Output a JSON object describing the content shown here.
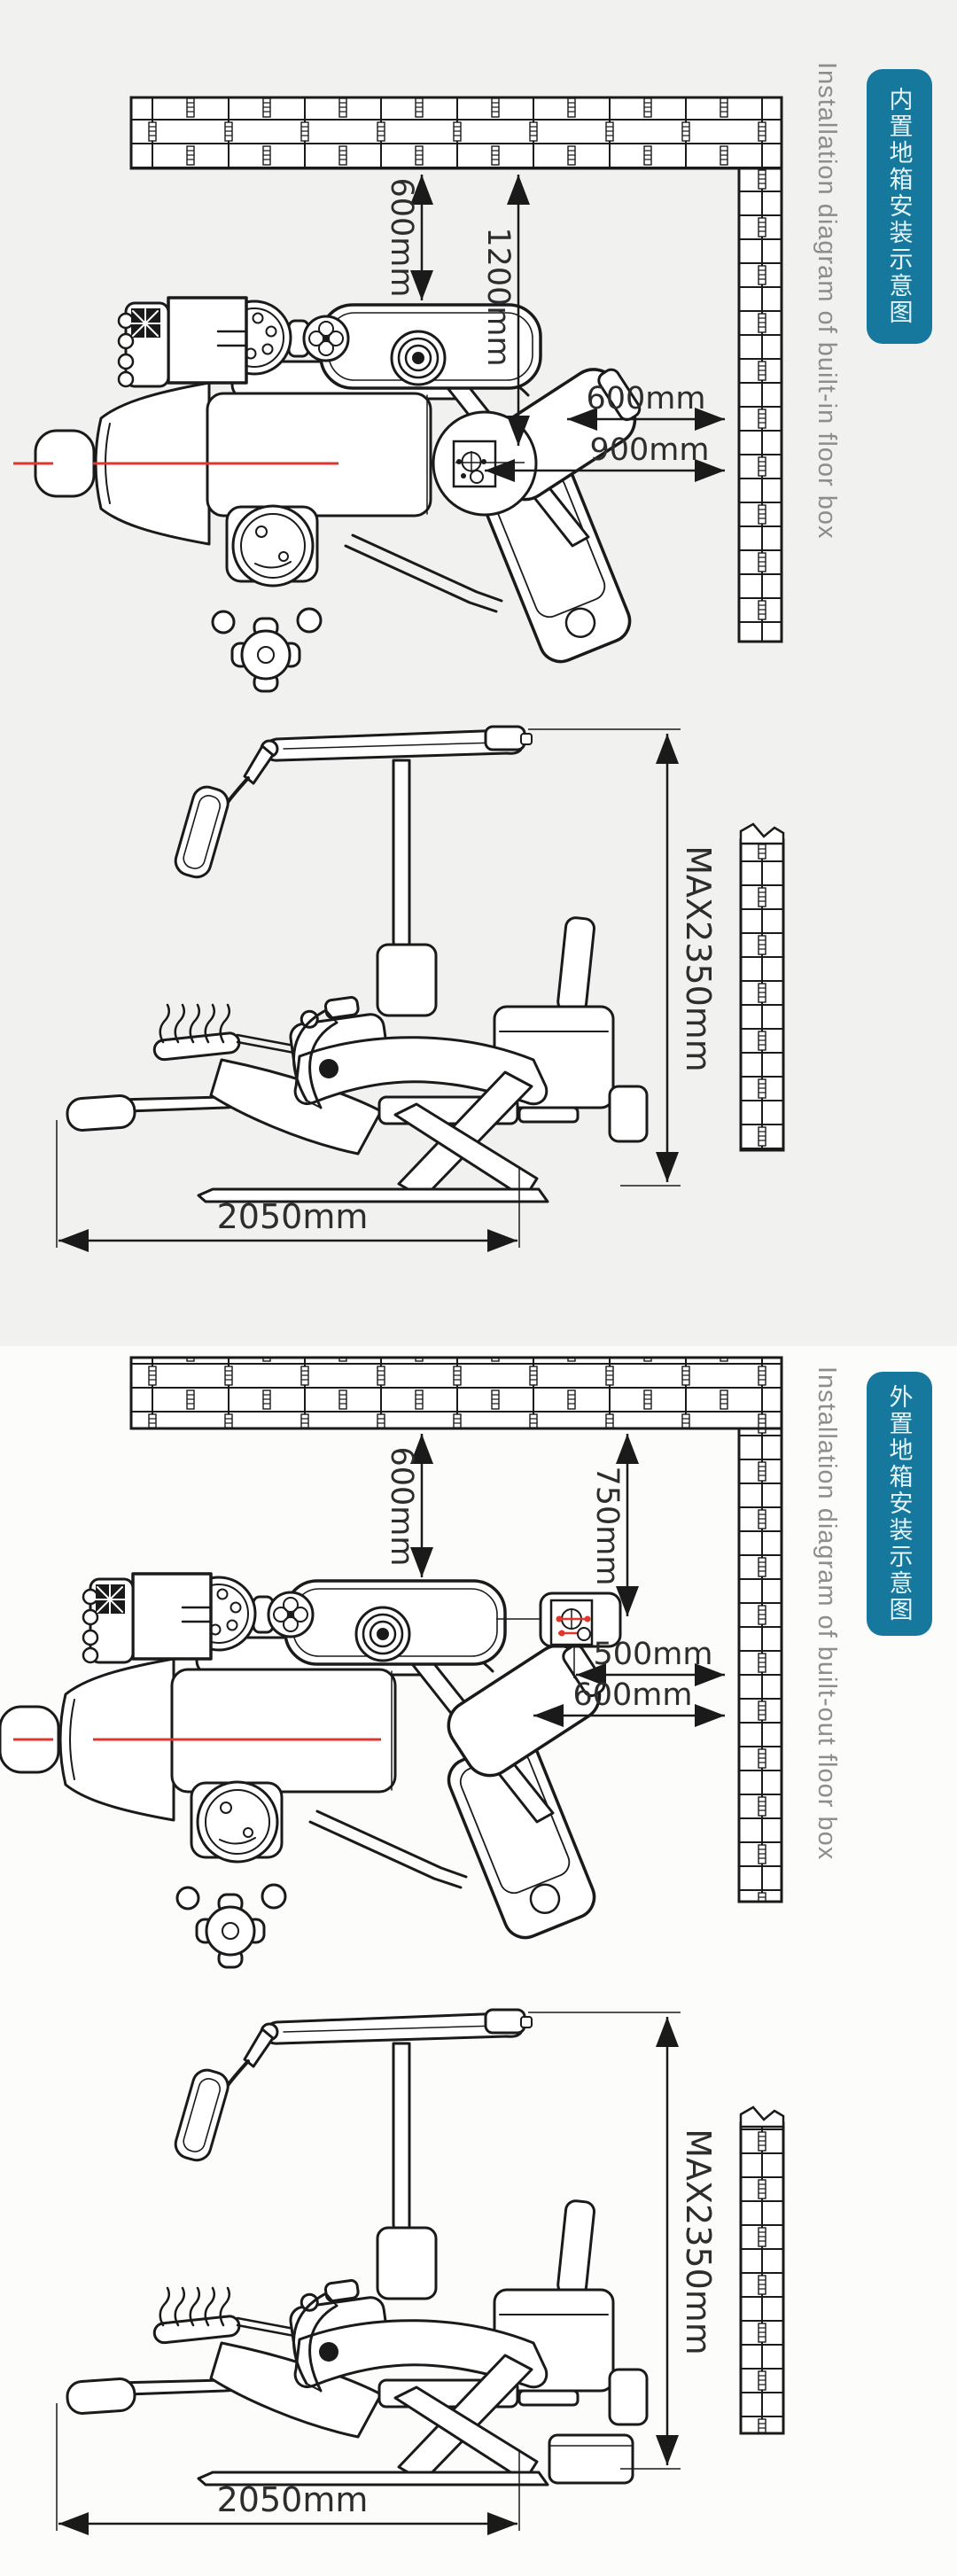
{
  "colors": {
    "badge_bg": "#17789e",
    "badge_text": "#e3f4f9",
    "caption_text": "#8d8d8d",
    "line_art": "#1a1a1a",
    "centerline_red": "#e0362c",
    "dim_text": "#2d2d2d",
    "section1_bg": "#f1f1ef",
    "section2_bg": "#fcfcfb"
  },
  "sections": [
    {
      "badge": "内置地箱安装示意图",
      "caption": "Installation diagram of built-in floor box",
      "top_view": {
        "dim_wall_to_unit": "600mm",
        "dim_wall_to_floorbox": "1200mm",
        "dim_unit_to_wall": "600mm",
        "dim_floorbox_to_wall": "900mm"
      },
      "side_view": {
        "dim_max_height": "MAX2350mm",
        "dim_length": "2050mm"
      }
    },
    {
      "badge": "外置地箱安装示意图",
      "caption": "Installation diagram of built-out floor box",
      "top_view": {
        "dim_wall_to_unit": "600mm",
        "dim_wall_to_floorbox": "750mm",
        "dim_floorbox_to_wall": "500mm",
        "dim_unit_to_wall": "600mm"
      },
      "side_view": {
        "dim_max_height": "MAX2350mm",
        "dim_length": "2050mm"
      }
    }
  ]
}
